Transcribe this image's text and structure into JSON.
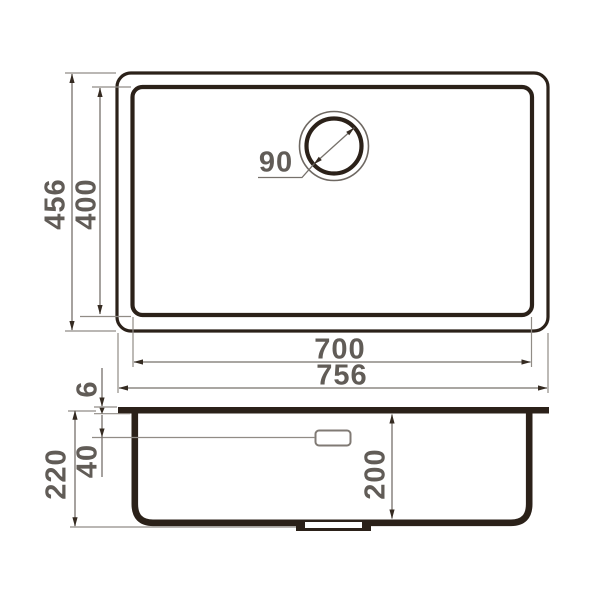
{
  "drawing_title": "undermount-sink-technical-drawing",
  "dimensions": {
    "top_outer_height": "456",
    "top_inner_height": "400",
    "drain_diameter": "90",
    "inner_width": "700",
    "outer_width": "756",
    "rim_thickness": "6",
    "total_depth": "220",
    "overflow_offset": "40",
    "bowl_depth": "200"
  },
  "colors": {
    "background": "#ffffff",
    "thick_line": "#2b2119",
    "dim_line": "#76716b",
    "extension_line": "#918c86",
    "arrowhead": "#352b22",
    "text": "#615c57"
  }
}
